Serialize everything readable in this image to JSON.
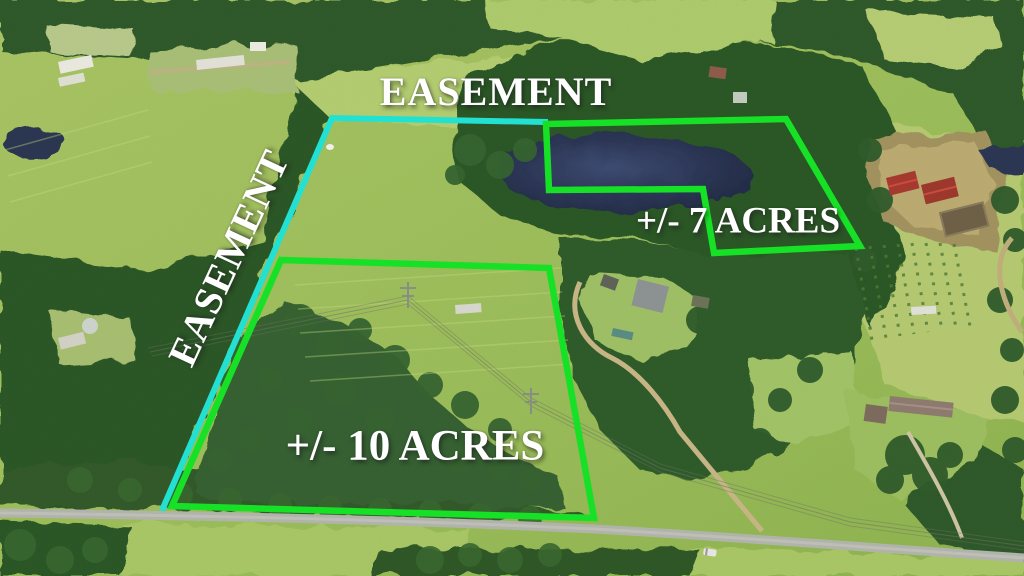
{
  "annotations": {
    "easement_top": "EASEMENT",
    "easement_left": "EASEMENT",
    "acres_7": "+/- 7 ACRES",
    "acres_10": "+/- 10 ACRES"
  },
  "overlays": {
    "boundary_color": "#17e126",
    "easement_color": "#23e1d2",
    "label_color": "#ffffff",
    "seven_acre_points": "546,124 786,119 860,246 714,253 703,189 549,190",
    "ten_acre_points": "281,260 549,268 594,518 172,506",
    "easement_points": "545,122 332,118 163,508"
  }
}
